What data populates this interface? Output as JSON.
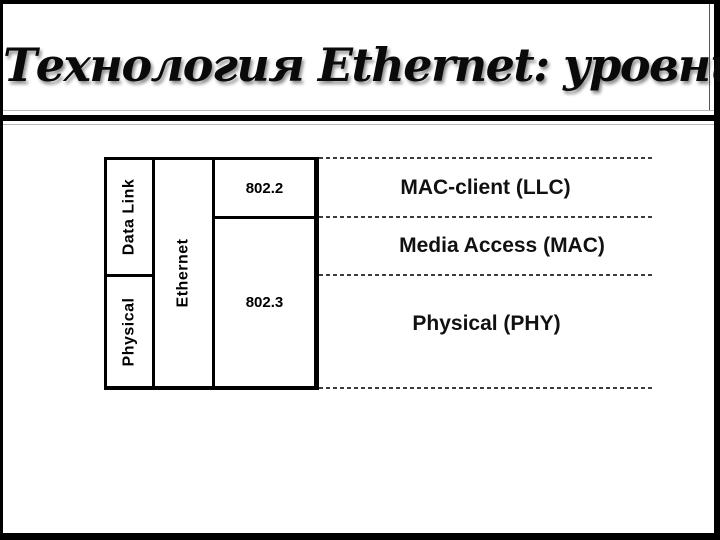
{
  "slide": {
    "title": "Технология Ethernet: уровни BRM OSI"
  },
  "diagram": {
    "osi_column": {
      "data_link": "Data Link",
      "physical": "Physical"
    },
    "ethernet_column": {
      "label": "Ethernet"
    },
    "standards_column": {
      "top": "802.2",
      "bottom": "802.3"
    },
    "sublayer_labels": {
      "llc": "MAC-client (LLC)",
      "mac": "Media Access (MAC)",
      "phy": "Physical (PHY)"
    }
  },
  "colors": {
    "frame": "#000000",
    "background": "#ffffff",
    "line": "#000000",
    "dashed_line": "#3c3c3c",
    "divider_thin": "#b9b9b9",
    "text": "#000000"
  }
}
